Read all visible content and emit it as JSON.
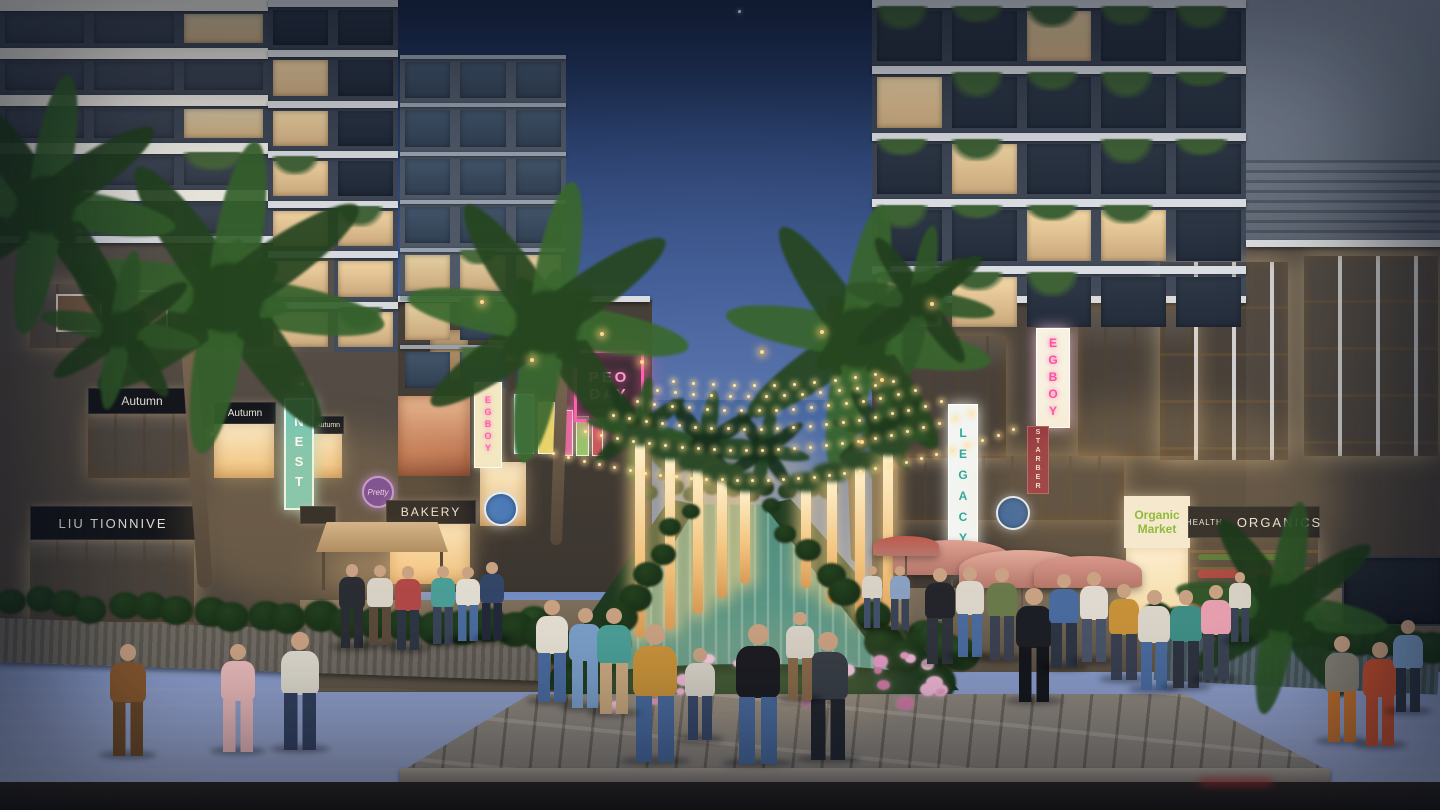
{
  "signs": {
    "soltanu": "Soltanu Fegara",
    "autumn": "Autumn",
    "nest": "NEST",
    "liu": "LIU TIONNIVE",
    "bakery": "BAKERY",
    "pretty": "Pretty",
    "legacy": "LEGACY",
    "egboy": "EGBOY",
    "starber": "STARBER",
    "health": "HEALTH",
    "organics": "ORGANICS",
    "market_l1": "Organic",
    "market_l2": "Market",
    "neon_l1": "PEO",
    "neon_l2": "DAY"
  },
  "colors": {
    "sky_top": "#1a2846",
    "sky_horizon": "#93a2cd",
    "facade_slate": "#39414f",
    "facade_panel": "#6b7482",
    "storefront_lit": "#f2cd92",
    "string_light": "#ffe6ad",
    "neon_pink": "#ff5fae",
    "sign_teal": "#74c6b4",
    "water": "#4e8a7c",
    "flowers_pink": "#e29ac0",
    "foliage_dark": "#24441f",
    "asphalt": "#221d18",
    "paver": "#8d8478"
  },
  "scene": {
    "grids": [
      {
        "x": 0,
        "y": 0,
        "w": 268,
        "h": 238,
        "cols": 3,
        "rows": 5,
        "kind": "balcony"
      },
      {
        "x": 268,
        "y": 0,
        "w": 130,
        "h": 352,
        "cols": 2,
        "rows": 7,
        "kind": "slate"
      },
      {
        "x": 400,
        "y": 55,
        "w": 166,
        "h": 338,
        "cols": 3,
        "rows": 7,
        "kind": "glass"
      },
      {
        "x": 872,
        "y": 0,
        "w": 374,
        "h": 332,
        "cols": 5,
        "rows": 5,
        "kind": "rightslate"
      }
    ],
    "palms": [
      {
        "cx": 228,
        "cy": 298,
        "r": 118,
        "c1": "#24441f",
        "c2": "#35612c",
        "z": 13,
        "t": [
          205,
          320,
          15,
          268,
          -4
        ]
      },
      {
        "cx": 46,
        "cy": 205,
        "r": 98,
        "c1": "#223f1e",
        "c2": "#325c2a",
        "z": 13
      },
      {
        "cx": 120,
        "cy": 330,
        "r": 60,
        "c1": "#223f1e",
        "c2": "#2f5628",
        "z": 13
      },
      {
        "cx": 548,
        "cy": 322,
        "r": 106,
        "c1": "#26461f",
        "c2": "#3a682e",
        "z": 5,
        "t": [
          556,
          340,
          12,
          205,
          2
        ]
      },
      {
        "cx": 858,
        "cy": 338,
        "r": 100,
        "c1": "#26461f",
        "c2": "#38652d",
        "z": 5,
        "t": [
          856,
          352,
          11,
          210,
          -2
        ]
      },
      {
        "cx": 920,
        "cy": 300,
        "r": 56,
        "c1": "#223f1e",
        "c2": "#2f5628",
        "z": 5
      },
      {
        "cx": 705,
        "cy": 446,
        "r": 42,
        "c1": "#16301c",
        "c2": "#234424",
        "z": 1
      },
      {
        "cx": 764,
        "cy": 450,
        "r": 34,
        "c1": "#16301c",
        "c2": "#234424",
        "z": 1
      },
      {
        "cx": 1282,
        "cy": 608,
        "r": 80,
        "c1": "#1d3a1c",
        "c2": "#2c5426",
        "z": 11
      },
      {
        "cx": 640,
        "cy": 430,
        "r": 40,
        "c1": "#1f3b1d",
        "c2": "#2d5227",
        "z": 5
      },
      {
        "cx": 880,
        "cy": 430,
        "r": 36,
        "c1": "#1f3b1d",
        "c2": "#2d5227",
        "z": 5
      }
    ],
    "lightTrunks": [
      {
        "x": 640,
        "y": 440,
        "h": 198
      },
      {
        "x": 670,
        "y": 454,
        "h": 176
      },
      {
        "x": 698,
        "y": 466,
        "h": 148
      },
      {
        "x": 722,
        "y": 476,
        "h": 122
      },
      {
        "x": 745,
        "y": 486,
        "h": 98
      },
      {
        "x": 806,
        "y": 486,
        "h": 102
      },
      {
        "x": 832,
        "y": 476,
        "h": 128
      },
      {
        "x": 860,
        "y": 464,
        "h": 158
      },
      {
        "x": 888,
        "y": 450,
        "h": 188
      }
    ],
    "strands": [
      {
        "x1": 552,
        "y1": 452,
        "x2": 1012,
        "y2": 428,
        "sag": 38,
        "n": 30
      },
      {
        "x1": 584,
        "y1": 430,
        "x2": 970,
        "y2": 412,
        "sag": 27,
        "n": 24
      },
      {
        "x1": 612,
        "y1": 414,
        "x2": 940,
        "y2": 400,
        "sag": 20,
        "n": 20
      },
      {
        "x1": 636,
        "y1": 400,
        "x2": 914,
        "y2": 389,
        "sag": 14,
        "n": 16
      },
      {
        "x1": 656,
        "y1": 389,
        "x2": 892,
        "y2": 380,
        "sag": 10,
        "n": 13
      },
      {
        "x1": 672,
        "y1": 380,
        "x2": 874,
        "y2": 373,
        "sag": 7,
        "n": 10
      }
    ],
    "bushRows": [
      {
        "x1": 688,
        "y1": 510,
        "x2": 578,
        "y2": 686,
        "n": 9,
        "r1": 9,
        "r2": 24,
        "c": "#24421f",
        "z": 6
      },
      {
        "x1": 770,
        "y1": 510,
        "x2": 928,
        "y2": 686,
        "n": 9,
        "r1": 9,
        "r2": 24,
        "c": "#24421f",
        "z": 6
      },
      {
        "x1": 652,
        "y1": 492,
        "x2": 826,
        "y2": 492,
        "n": 10,
        "r1": 9,
        "r2": 10,
        "c": "#2c4a28",
        "z": 5
      },
      {
        "x1": 8,
        "y1": 604,
        "x2": 548,
        "y2": 634,
        "n": 20,
        "r1": 15,
        "r2": 21,
        "c": "#23401f",
        "z": 10
      },
      {
        "x1": 1158,
        "y1": 620,
        "x2": 1435,
        "y2": 648,
        "n": 15,
        "r1": 15,
        "r2": 19,
        "c": "#23401f",
        "z": 10
      },
      {
        "x1": 536,
        "y1": 626,
        "x2": 566,
        "y2": 652,
        "n": 4,
        "r1": 16,
        "r2": 20,
        "c": "#2a4c24",
        "z": 8
      },
      {
        "x1": 924,
        "y1": 634,
        "x2": 956,
        "y2": 658,
        "n": 4,
        "r1": 16,
        "r2": 20,
        "c": "#2a4c24",
        "z": 8
      }
    ],
    "flowerBeds": [
      {
        "x": 568,
        "y": 650,
        "w": 372,
        "h": 52,
        "n": 26,
        "colors": [
          "#e29ac0",
          "#d17ba6",
          "#efb6d2",
          "#f3c9da"
        ],
        "z": 9
      },
      {
        "x": 1226,
        "y": 592,
        "w": 96,
        "h": 40,
        "n": 9,
        "colors": [
          "#c04848",
          "#d86a5a",
          "#e8907e"
        ],
        "z": 10
      }
    ],
    "bokeh": [
      [
        250,
        330
      ],
      [
        300,
        382
      ],
      [
        210,
        432
      ],
      [
        480,
        300
      ],
      [
        530,
        358
      ],
      [
        600,
        332
      ],
      [
        820,
        330
      ],
      [
        880,
        378
      ],
      [
        930,
        302
      ],
      [
        860,
        440
      ],
      [
        640,
        360
      ],
      [
        760,
        350
      ],
      [
        1280,
        580
      ],
      [
        1310,
        610
      ],
      [
        170,
        300
      ],
      [
        120,
        362
      ]
    ],
    "umbrellas": [
      {
        "x": 952,
        "y": 540,
        "w": 118,
        "c": "#dfa191"
      },
      {
        "x": 1022,
        "y": 550,
        "w": 126,
        "c": "#e2ab9a"
      },
      {
        "x": 1088,
        "y": 556,
        "w": 108,
        "c": "#d9978a"
      },
      {
        "x": 906,
        "y": 536,
        "w": 66,
        "c": "#bf5a4e"
      }
    ],
    "people": [
      [
        128,
        756,
        112,
        "#8a5a2e",
        "#6e4a26"
      ],
      [
        238,
        752,
        108,
        "#e8b8b8",
        "#e8b8b8"
      ],
      [
        300,
        750,
        118,
        "#ddd8cc",
        "#33415e"
      ],
      [
        655,
        762,
        138,
        "#c8923a",
        "#4a6b9e"
      ],
      [
        758,
        764,
        140,
        "#1d1d22",
        "#4a6b9e"
      ],
      [
        700,
        740,
        92,
        "#d8d2c6",
        "#3a4a6a"
      ],
      [
        352,
        648,
        84,
        "#2a2d33",
        "#2a2d33"
      ],
      [
        380,
        645,
        80,
        "#d8d2c6",
        "#5a4a3a"
      ],
      [
        408,
        650,
        84,
        "#b04848",
        "#2e3644"
      ],
      [
        443,
        644,
        78,
        "#4a9e96",
        "#3a4458"
      ],
      [
        468,
        641,
        74,
        "#e0dcd2",
        "#4a6b9e"
      ],
      [
        492,
        640,
        78,
        "#334668",
        "#23293a"
      ],
      [
        552,
        702,
        102,
        "#e4ded2",
        "#4a6b9e"
      ],
      [
        585,
        708,
        100,
        "#7a9ec8",
        "#7a9ec8"
      ],
      [
        614,
        714,
        106,
        "#4a9e96",
        "#caa87e"
      ],
      [
        828,
        760,
        128,
        "#3a3f46",
        "#23262c"
      ],
      [
        800,
        700,
        88,
        "#d8d2c6",
        "#8a6a4a"
      ],
      [
        872,
        628,
        62,
        "#d8d2c6",
        "#44506a"
      ],
      [
        900,
        630,
        64,
        "#8aa0c0",
        "#3a4458"
      ],
      [
        940,
        664,
        96,
        "#24262c",
        "#30343c"
      ],
      [
        970,
        657,
        90,
        "#dcd6ca",
        "#4a6b9e"
      ],
      [
        1002,
        660,
        92,
        "#6b7a4a",
        "#3c4250"
      ],
      [
        1034,
        702,
        114,
        "#1d1f26",
        "#15171c"
      ],
      [
        1064,
        668,
        94,
        "#4a6b9e",
        "#2e3644"
      ],
      [
        1094,
        662,
        90,
        "#e0dad0",
        "#4a5468"
      ],
      [
        1124,
        680,
        96,
        "#c8923a",
        "#3a4050"
      ],
      [
        1154,
        690,
        100,
        "#dcd6ca",
        "#4a6b9e"
      ],
      [
        1186,
        688,
        98,
        "#3f8e86",
        "#2e3440"
      ],
      [
        1216,
        680,
        95,
        "#e8a0b0",
        "#3c4454"
      ],
      [
        1240,
        642,
        70,
        "#d8d2c6",
        "#3a4458"
      ],
      [
        1342,
        742,
        106,
        "#8a8578",
        "#c8732e"
      ],
      [
        1380,
        746,
        104,
        "#c8502e",
        "#c8502e"
      ],
      [
        1408,
        712,
        92,
        "#7a9ec8",
        "#2e3644"
      ]
    ]
  }
}
